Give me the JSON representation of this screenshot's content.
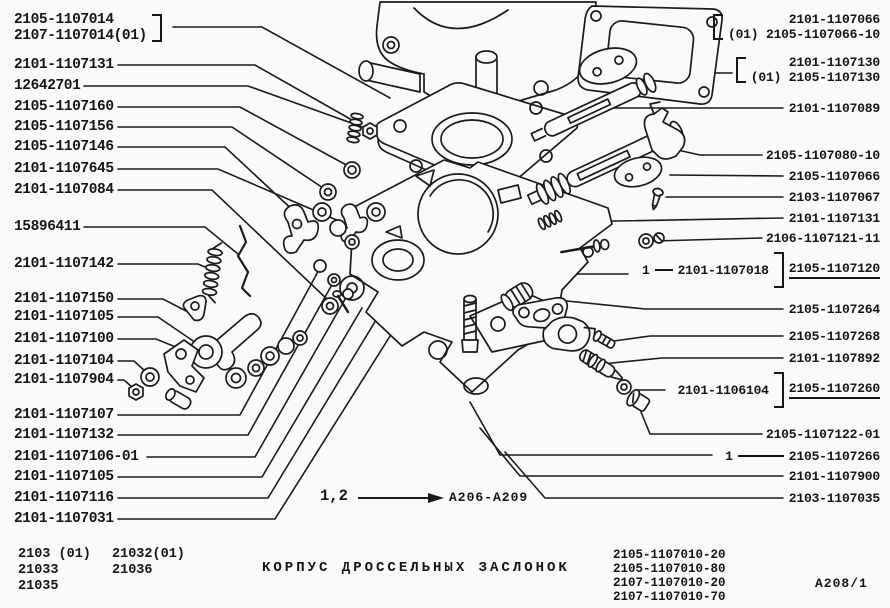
{
  "drawing": {
    "title": "КОРПУС ДРОССЕЛЬНЫХ ЗАСЛОНОК",
    "sheet_code": "А208/1",
    "footnote": {
      "marker": "1,2",
      "ref": "А206-А209"
    },
    "left_group": {
      "line1": "2105-1107014",
      "line2": "2107-1107014(01)"
    },
    "left_labels": [
      "2101-1107131",
      "12642701",
      "2105-1107160",
      "2105-1107156",
      "2105-1107146",
      "2101-1107645",
      "2101-1107084",
      "15896411",
      "2101-1107142",
      "2101-1107150",
      "2101-1107105",
      "2101-1107100",
      "2101-1107104",
      "2101-1107904",
      "2101-1107107",
      "2101-1107132",
      "2101-1107106-01",
      "2101-1107105",
      "2101-1107116",
      "2101-1107031"
    ],
    "right_group_1": {
      "line1": "2101-1107066",
      "line2": "(01) 2105-1107066-10"
    },
    "right_group_2": {
      "line1": "2101-1107130",
      "line2": "(01) 2105-1107130"
    },
    "right_labels": [
      "2101-1107089",
      "2105-1107080-10",
      "2105-1107066",
      "2103-1107067",
      "2101-1107131",
      "2106-1107121-11",
      "2105-1107264",
      "2105-1107268",
      "2101-1107892",
      "2105-1107122-01",
      "2101-1107900",
      "2103-1107035"
    ],
    "callout_1018": {
      "marker": "1",
      "number": "2101-1107018",
      "group_ref": "2105-1107120"
    },
    "callout_6104": {
      "number": "2101-1106104",
      "group_ref": "2105-1107260"
    },
    "callout_7266": {
      "marker": "1",
      "number": "2105-1107266"
    },
    "models_left_col1": "2103 (01)\n21033\n21035",
    "models_left_col2": "21032(01)\n21036",
    "models_right": "2105-1107010-20\n2105-1107010-80\n2107-1107010-20\n2107-1107010-70"
  }
}
